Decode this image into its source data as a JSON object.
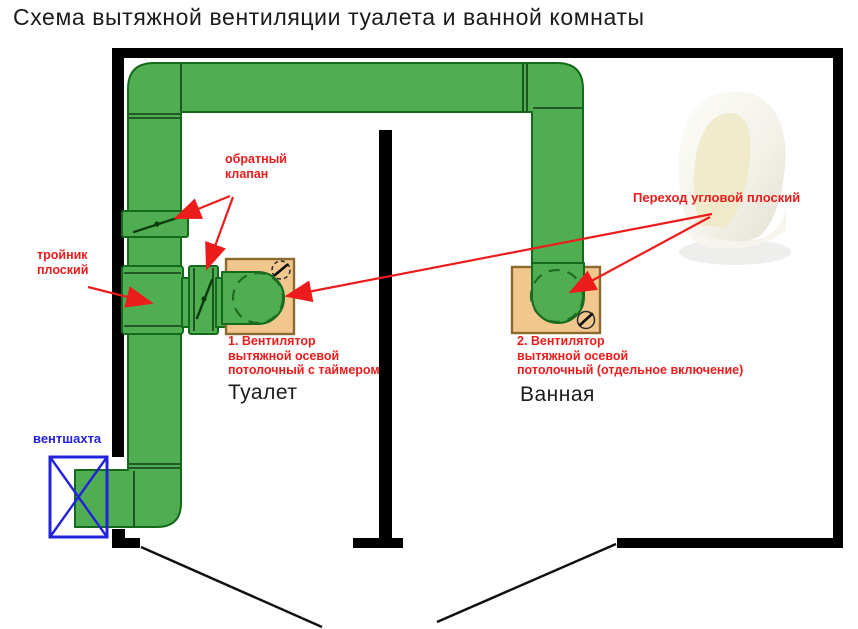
{
  "title": "Схема вытяжной вентиляции туалета и ванной комнаты",
  "colors": {
    "duct-green": "#4fae52",
    "duct-green-dark": "#15691a",
    "fan-box-tan": "#f2c78e",
    "fan-box-brown": "#8a6a30",
    "annotation-red": "#ed1c1c",
    "shaft-blue": "#2222dd",
    "wall-black": "#000000"
  },
  "labels": {
    "check_valve": "обратный\nклапан",
    "tee": "тройник\nплоский",
    "corner_transition": "Переход угловой плоский",
    "vent_shaft": "вентшахта",
    "fan1": "1. Вентилятор\nвытяжной осевой\nпотолочный с таймером",
    "fan2": "2. Вентилятор\nвытяжной осевой\nпотолочный (отдельное включение)",
    "room_toilet": "Туалет",
    "room_bathroom": "Ванная"
  }
}
